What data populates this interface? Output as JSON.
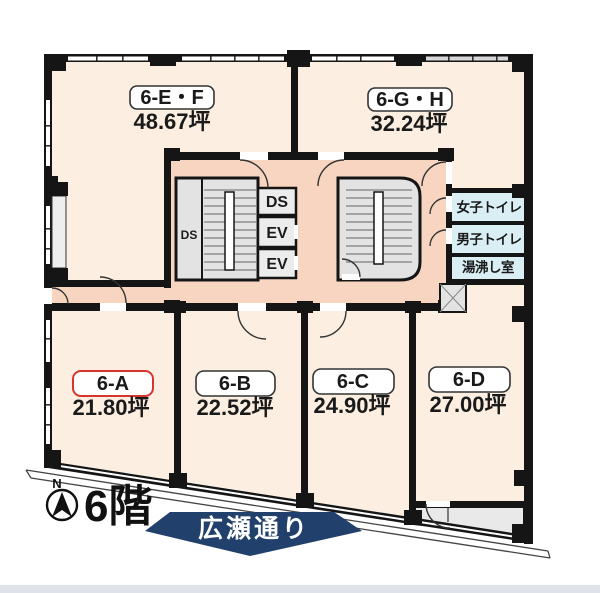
{
  "floor": {
    "label": "6階"
  },
  "compass": {
    "north": "N"
  },
  "street": {
    "label": "広瀬通り"
  },
  "units": {
    "ef": {
      "id": "6-E・F",
      "area": "48.67坪"
    },
    "gh": {
      "id": "6-G・H",
      "area": "32.24坪"
    },
    "a": {
      "id": "6-A",
      "area": "21.80坪"
    },
    "b": {
      "id": "6-B",
      "area": "22.52坪"
    },
    "c": {
      "id": "6-C",
      "area": "24.90坪"
    },
    "d": {
      "id": "6-D",
      "area": "27.00坪"
    }
  },
  "core": {
    "duct_side": "DS",
    "duct_top": "DS",
    "ev1": "EV",
    "ev2": "EV"
  },
  "facilities": {
    "women": "女子トイレ",
    "men": "男子トイレ",
    "kitchen": "湯沸し室"
  },
  "colors": {
    "room": "#fcefe1",
    "corridor": "#f8d5c0",
    "wet_area": "#d9eff4",
    "stairs": "#e3e3e3",
    "shaft_box": "#ececec",
    "vestibule": "#e9e9e9",
    "wall": "#151515",
    "highlight": "#d8352e",
    "banner": "#21406b",
    "footer_strip": "#dfe2e8"
  }
}
